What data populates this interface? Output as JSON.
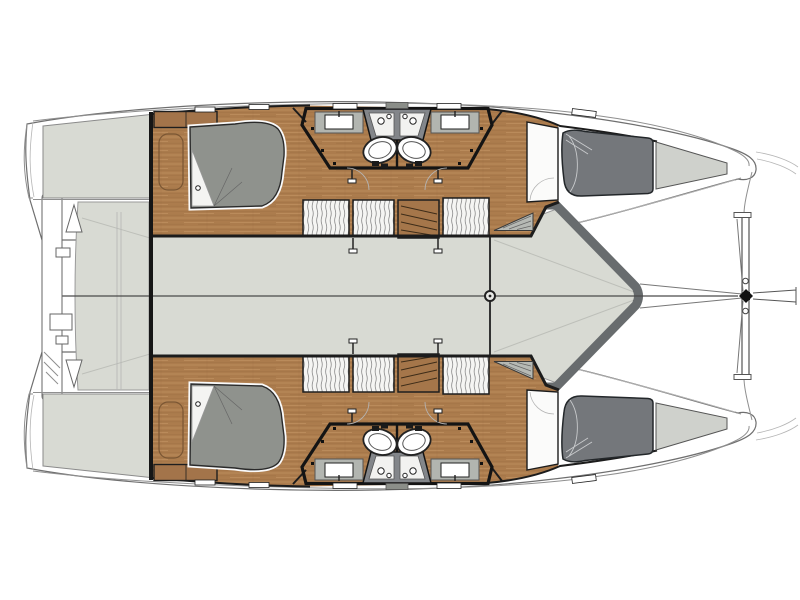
{
  "page": {
    "title": "Catamaran deck and accommodation plan",
    "background": "#ffffff"
  },
  "palette": {
    "background": "#ffffff",
    "deck": "#d8dad3",
    "wood": "#ac7c4d",
    "wood_light": "#c79a6a",
    "wood_dark": "#8a5f36",
    "shelf_wood": "#a3744a",
    "stair_wood": "#a5764a",
    "bed_aft": "#8f928d",
    "bed_forward": "#74777b",
    "bed_forward_foot": "#cfd1cc",
    "coaming": "#686c6e",
    "bathroom_floor": "#d6d8d2",
    "counter": "#b2b5b0",
    "shower_wall": "#83868a",
    "step_tread": "#b6b9b4",
    "walls": "#161616",
    "hull_outline": "#6f6f6f",
    "rigging": "#555555",
    "centerline": "#4a4a4a",
    "hatch_stroke": "#8a8a8a",
    "fixture_white": "#ffffff"
  },
  "diagram": {
    "type": "boat-floor-plan",
    "subject": "catamaran sailing yacht - deck and accommodation layout, top view",
    "orientation": {
      "bow": "right",
      "stern": "left"
    },
    "symmetry": "port and starboard hulls mirrored about the centerline",
    "configuration": "4 cabins / 4 bathrooms",
    "central_areas": [
      {
        "name": "aft-cockpit"
      },
      {
        "name": "salon-deck"
      },
      {
        "name": "foredeck"
      },
      {
        "name": "mast-foot"
      },
      {
        "name": "trampoline"
      },
      {
        "name": "forward-crossbeam"
      },
      {
        "name": "bowsprit-fitting"
      },
      {
        "name": "stern-davit-structure"
      }
    ],
    "per_hull_areas": [
      {
        "name": "transom-platform"
      },
      {
        "name": "aft-cabin-double-berth"
      },
      {
        "name": "side-shelf"
      },
      {
        "name": "wardrobe-lockers",
        "count": 3
      },
      {
        "name": "companionway-stairs"
      },
      {
        "name": "bathroom",
        "count": 2,
        "fixtures": [
          "sink",
          "toilet",
          "shower"
        ]
      },
      {
        "name": "forward-cabin-double-berth"
      }
    ]
  }
}
